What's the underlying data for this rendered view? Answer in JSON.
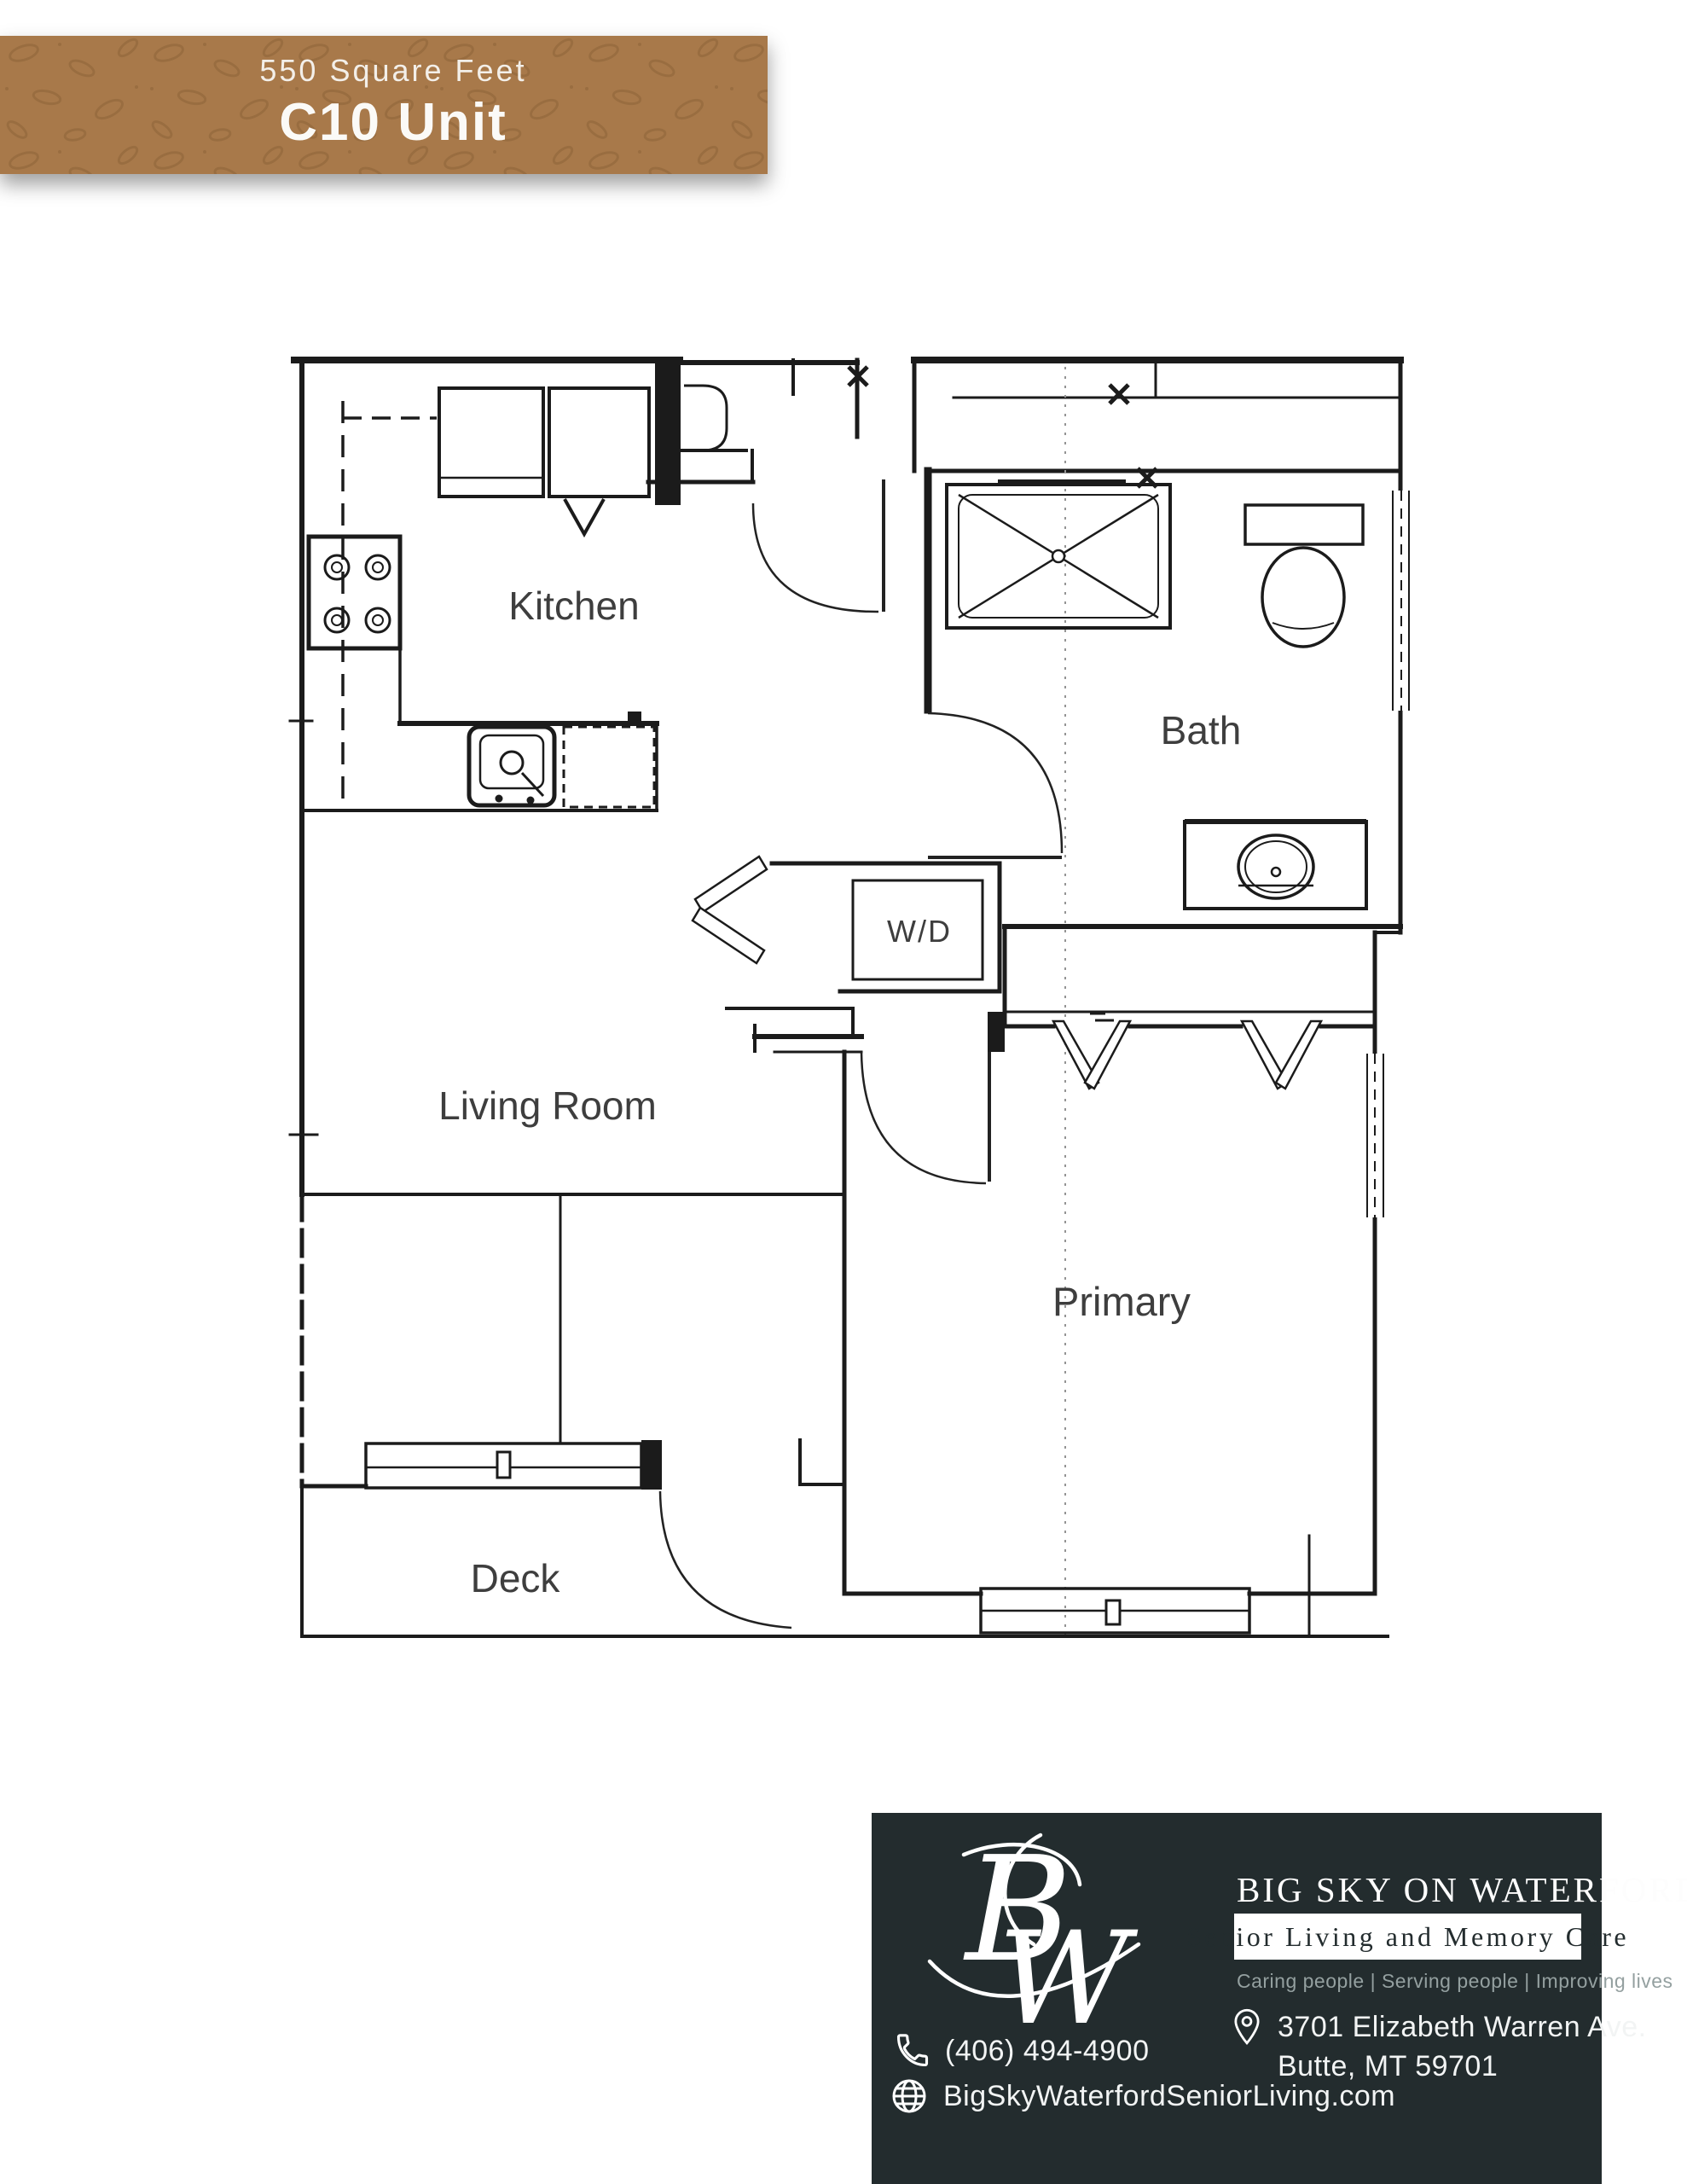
{
  "banner": {
    "sqft_label": "550 Square Feet",
    "unit_label": "C10 Unit"
  },
  "floorplan": {
    "rooms": {
      "kitchen": "Kitchen",
      "bath": "Bath",
      "washer_dryer": "W/D",
      "living_room": "Living Room",
      "primary": "Primary",
      "deck": "Deck"
    }
  },
  "footer": {
    "monogram_b": "B",
    "monogram_w": "W",
    "brand": "BIG SKY ON WATERFORD",
    "subtitle": "Senior Living and Memory Care",
    "tagline": "Caring people |  Serving people  |  Improving lives",
    "phone": "(406) 494-4900",
    "address_line1": "3701 Elizabeth Warren Ave.",
    "address_line2": "Butte, MT 59701",
    "website": "BigSkyWaterfordSeniorLiving.com",
    "icons": {
      "phone": "handset-outline",
      "location": "map-pin-outline",
      "website": "globe-outline"
    }
  },
  "colors": {
    "banner_brown": "#a8794a",
    "banner_seed": "#8a6136",
    "footer_bg": "#232c2e",
    "wall_ink": "#1b1b1b",
    "label_gray": "#3e3e3e"
  }
}
